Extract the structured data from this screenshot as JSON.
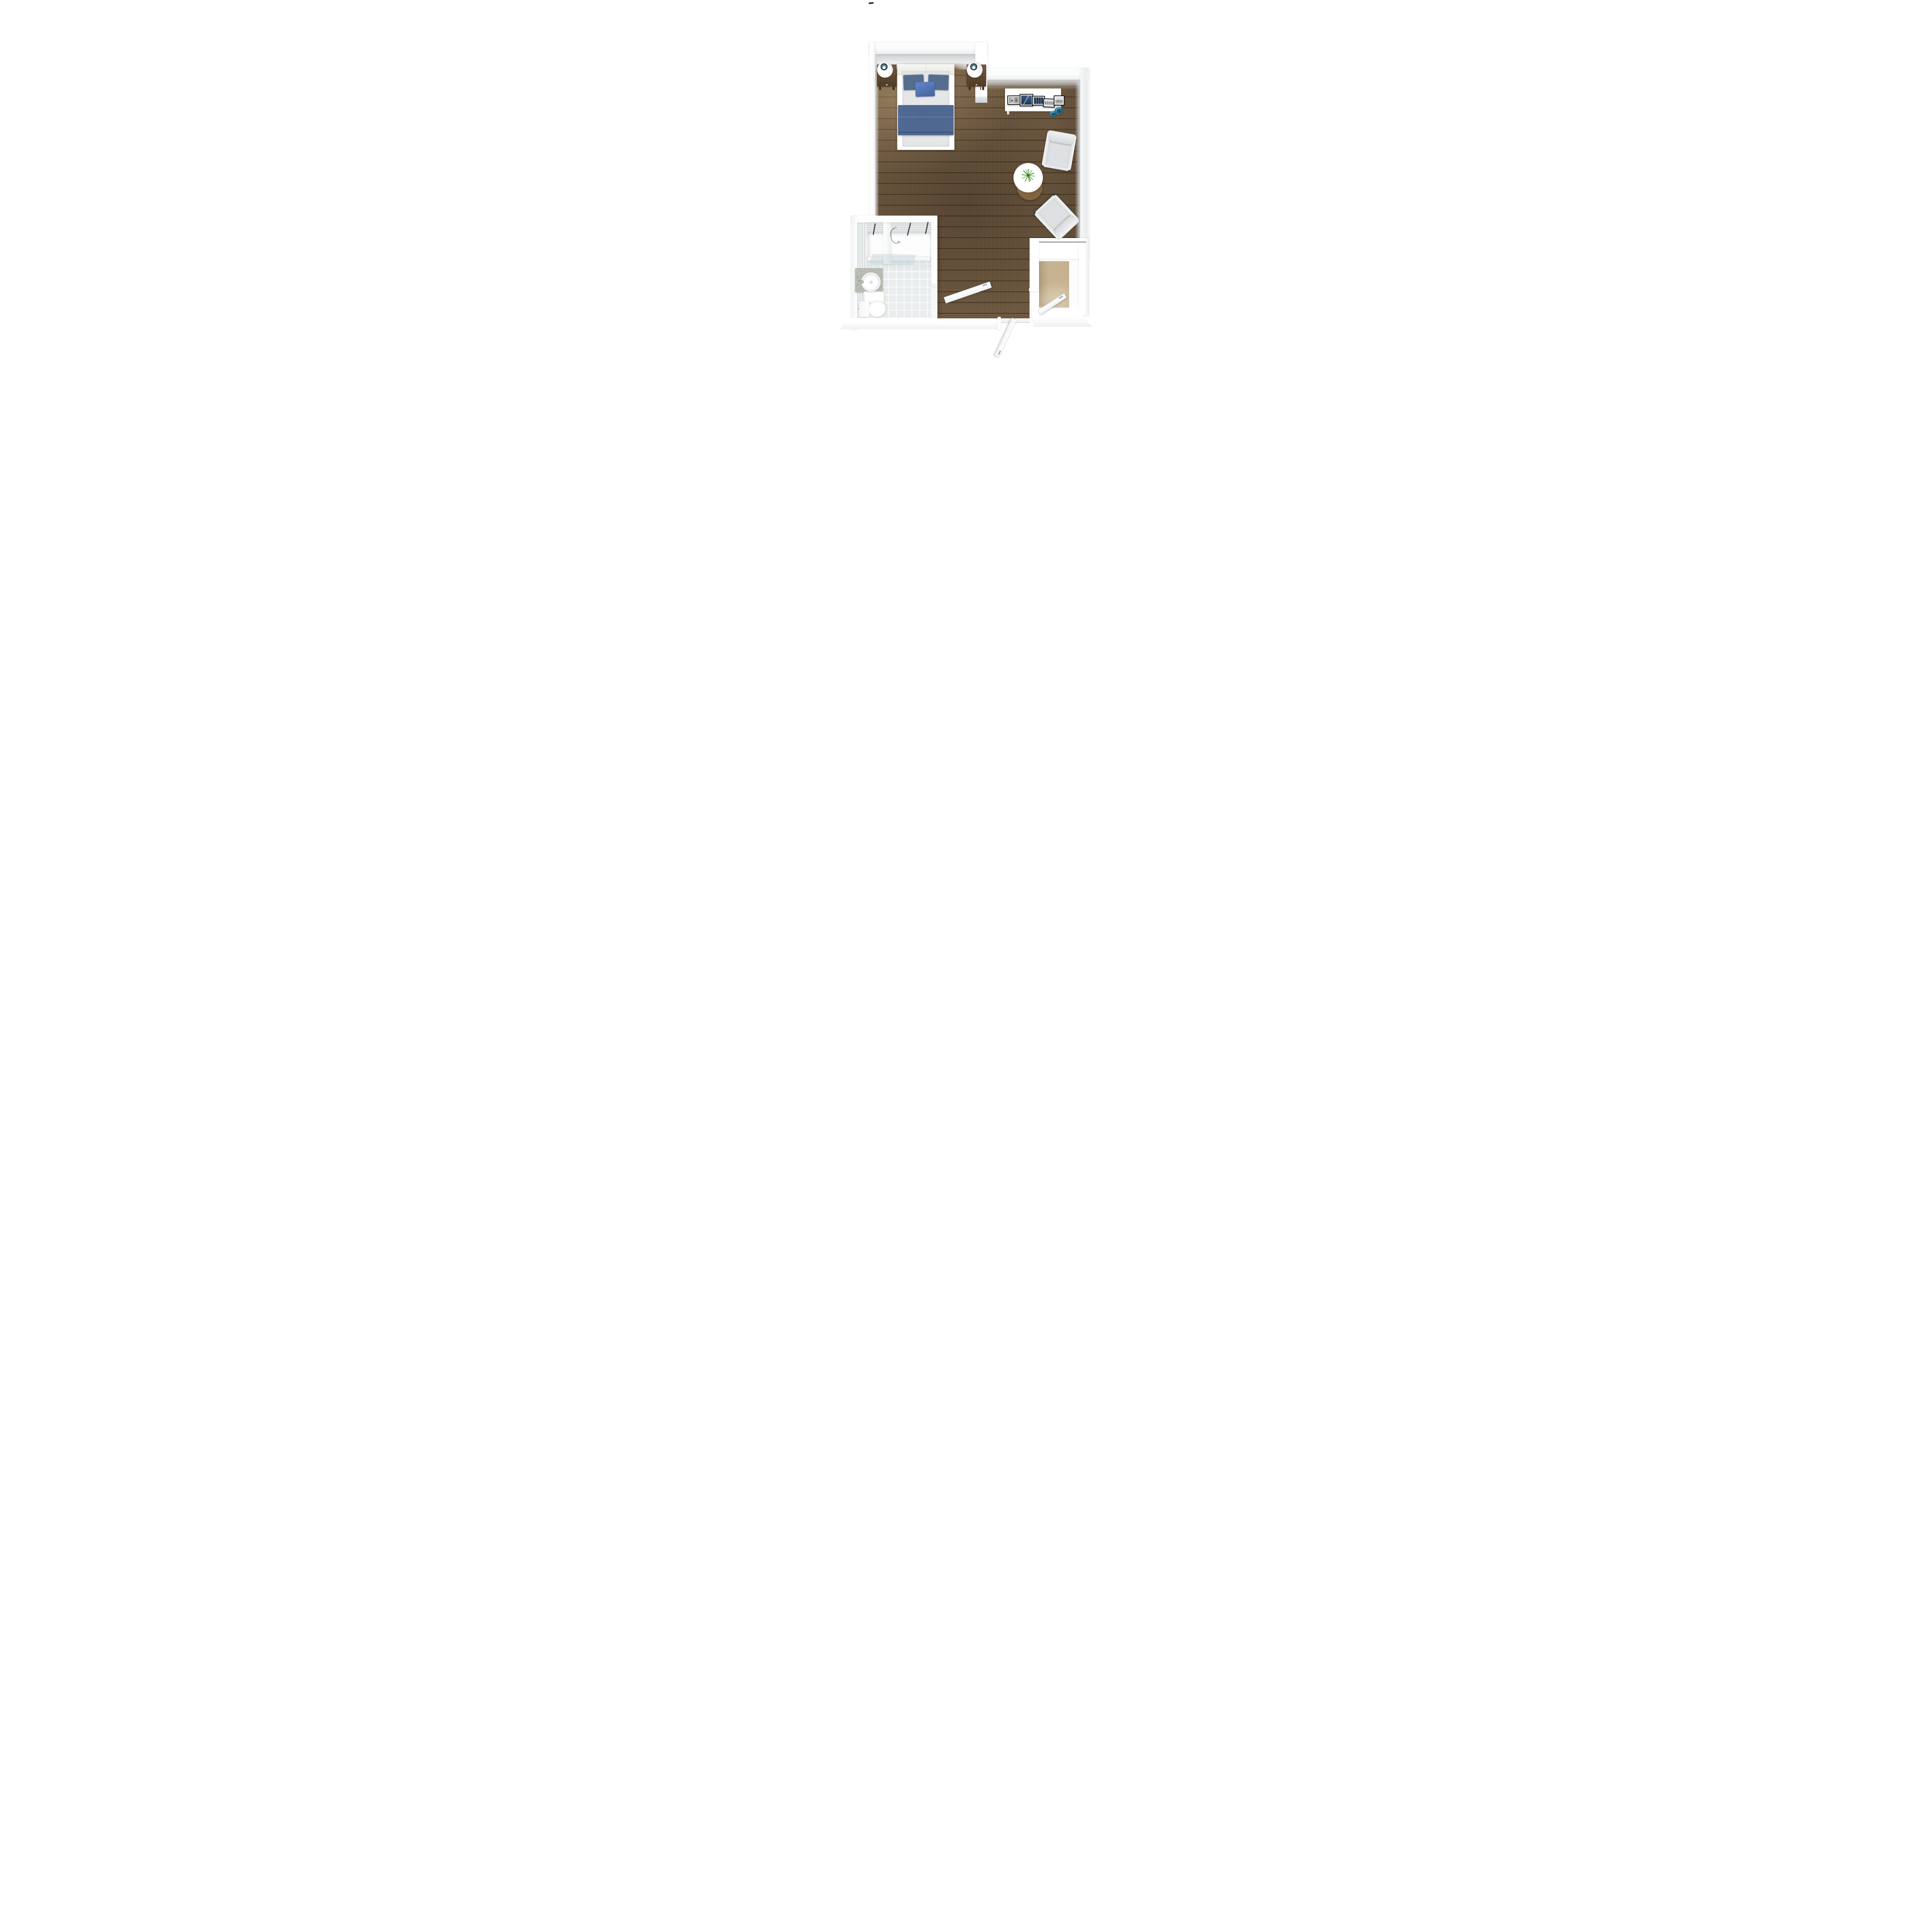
{
  "scene": {
    "title": "3D top-down floor plan of a studio apartment",
    "view": "top-down-3d-render",
    "background": "#ffffff"
  },
  "palette": {
    "wall_white": "#ffffff",
    "wall_shade": "#e9ebec",
    "glossy_wall_face": "#cdd0d2",
    "hardwood_floor": "#6f5940",
    "plank_seam": "#23180c",
    "closet_carpet": "#c8b391",
    "bathroom_tile": "#e9eded",
    "tile_grout": "#fafcfc",
    "mattress_gray": "#e4e6e7",
    "blanket_blue": "#47628e",
    "pillow_dark_blue": "#4d6689",
    "pillow_accent_blue": "#5c80c2",
    "headboard_cream": "#f2f2ee",
    "nightstand_wood": "#654b31",
    "lamp_teal": "#3f7b8d",
    "tv_dark": "#3a3d40",
    "picture_frame_black": "#17191c",
    "decor_bowl_teal": "#2a6d8e",
    "armchair_gray": "#dcdfe1",
    "side_table_wood": "#8a6a44",
    "plant_green": "#4c9a2f",
    "granite_counter": "#b7bbb1",
    "chrome": "#9aa1a6",
    "grab_bar": "#45494d",
    "shower_glass": "#c4d2d6"
  },
  "rooms": [
    {
      "id": "bedroom-living-area",
      "floor": "hardwood"
    },
    {
      "id": "bathroom",
      "floor": "tile"
    },
    {
      "id": "closet-entry",
      "floor": "carpet"
    }
  ],
  "furniture": [
    "double-bed",
    "headboard",
    "pillows",
    "blanket",
    "nightstand-left",
    "nightstand-right",
    "table-lamp-left",
    "table-lamp-right",
    "wall-mounted-tv",
    "credenza",
    "picture-frame-1",
    "picture-frame-2",
    "picture-frame-3",
    "picture-frame-4",
    "picture-frame-5",
    "decor-bowl-1",
    "decor-bowl-2",
    "armchair-top",
    "armchair-bottom",
    "round-side-table",
    "potted-plant"
  ],
  "fixtures": [
    "bathtub-shower",
    "shower-glass-panel",
    "shower-fixture",
    "grab-bars",
    "vanity-granite-counter",
    "round-sink",
    "faucet",
    "toilet"
  ],
  "doors": [
    "bathroom-door",
    "entry-door",
    "closet-door"
  ]
}
